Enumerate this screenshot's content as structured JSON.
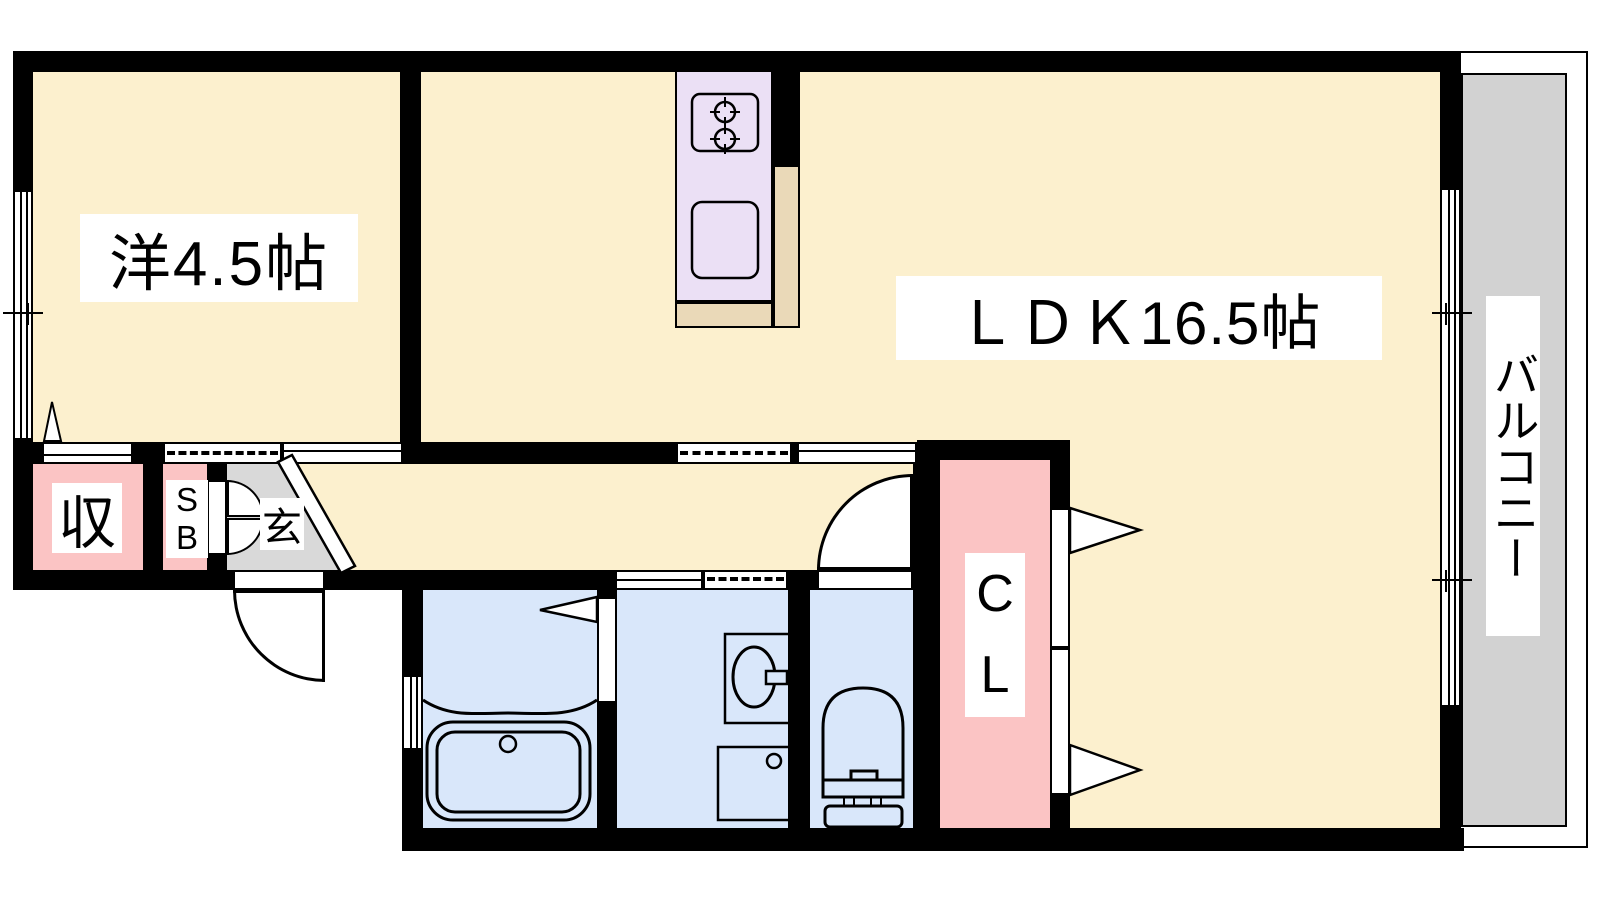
{
  "floorplan": {
    "rooms": {
      "western": {
        "label": "洋4.5帖"
      },
      "ldk": {
        "label": "ＬＤＫ16.5帖"
      },
      "balcony": {
        "label": "バルコニー"
      },
      "storage": {
        "label": "収"
      },
      "shoe_box": {
        "label": "S\nB"
      },
      "entrance": {
        "label": "玄"
      },
      "closet": {
        "label": "C\nL"
      }
    },
    "fixtures": {
      "stove": "two-burner-stove-icon",
      "kitchen_sink": "kitchen-sink-icon",
      "bathtub": "bathtub-icon",
      "washbasin": "washbasin-icon",
      "washer_pan": "washing-machine-pan-icon",
      "toilet": "toilet-icon"
    },
    "colors": {
      "floor_cream": "#FCF0CE",
      "storage_pink": "#FBC4C4",
      "wet_blue": "#D9E7FA",
      "kitchen_lavender": "#EBE0F5",
      "counter_tan": "#EAD9B8",
      "entrance_gray": "#D9D9D9",
      "balcony_gray": "#D2D2D2",
      "wall_black": "#000000",
      "label_bg": "#FFFFFF"
    }
  }
}
